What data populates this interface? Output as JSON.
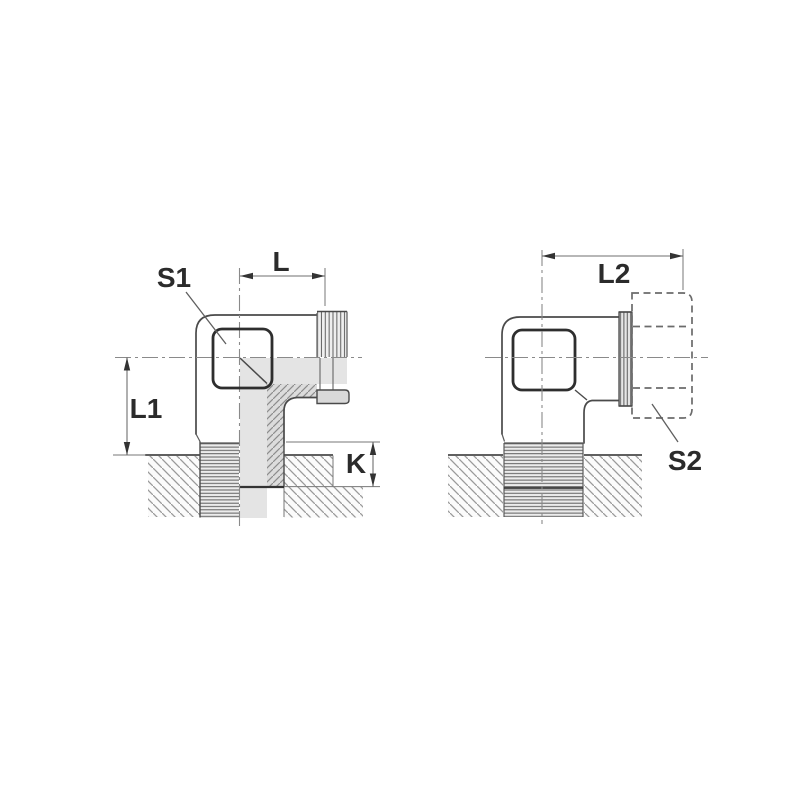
{
  "page": {
    "background_color": "#ffffff"
  },
  "drawing": {
    "type": "technical-engineering-drawing",
    "subject": "elbow stud fitting shown in two sectioned side views with dimension callouts",
    "left_view": {
      "labels": {
        "s1": "S1",
        "l": "L",
        "l1": "L1",
        "k": "K"
      }
    },
    "right_view": {
      "labels": {
        "l2": "L2",
        "s2": "S2"
      }
    },
    "colors": {
      "outline": "#4a4a4a",
      "section_fill": "#e4e4e4",
      "section_wall_fill": "#dcdcdc",
      "hatch_line": "#9a9a9a",
      "thread_line": "#5f5f5f",
      "dimension_line": "#6f6f6f",
      "arrow": "#333333",
      "label_text": "#2b2b2b",
      "centerline": "#8a8a8a",
      "nut_dash": "#6b6b6b"
    }
  }
}
